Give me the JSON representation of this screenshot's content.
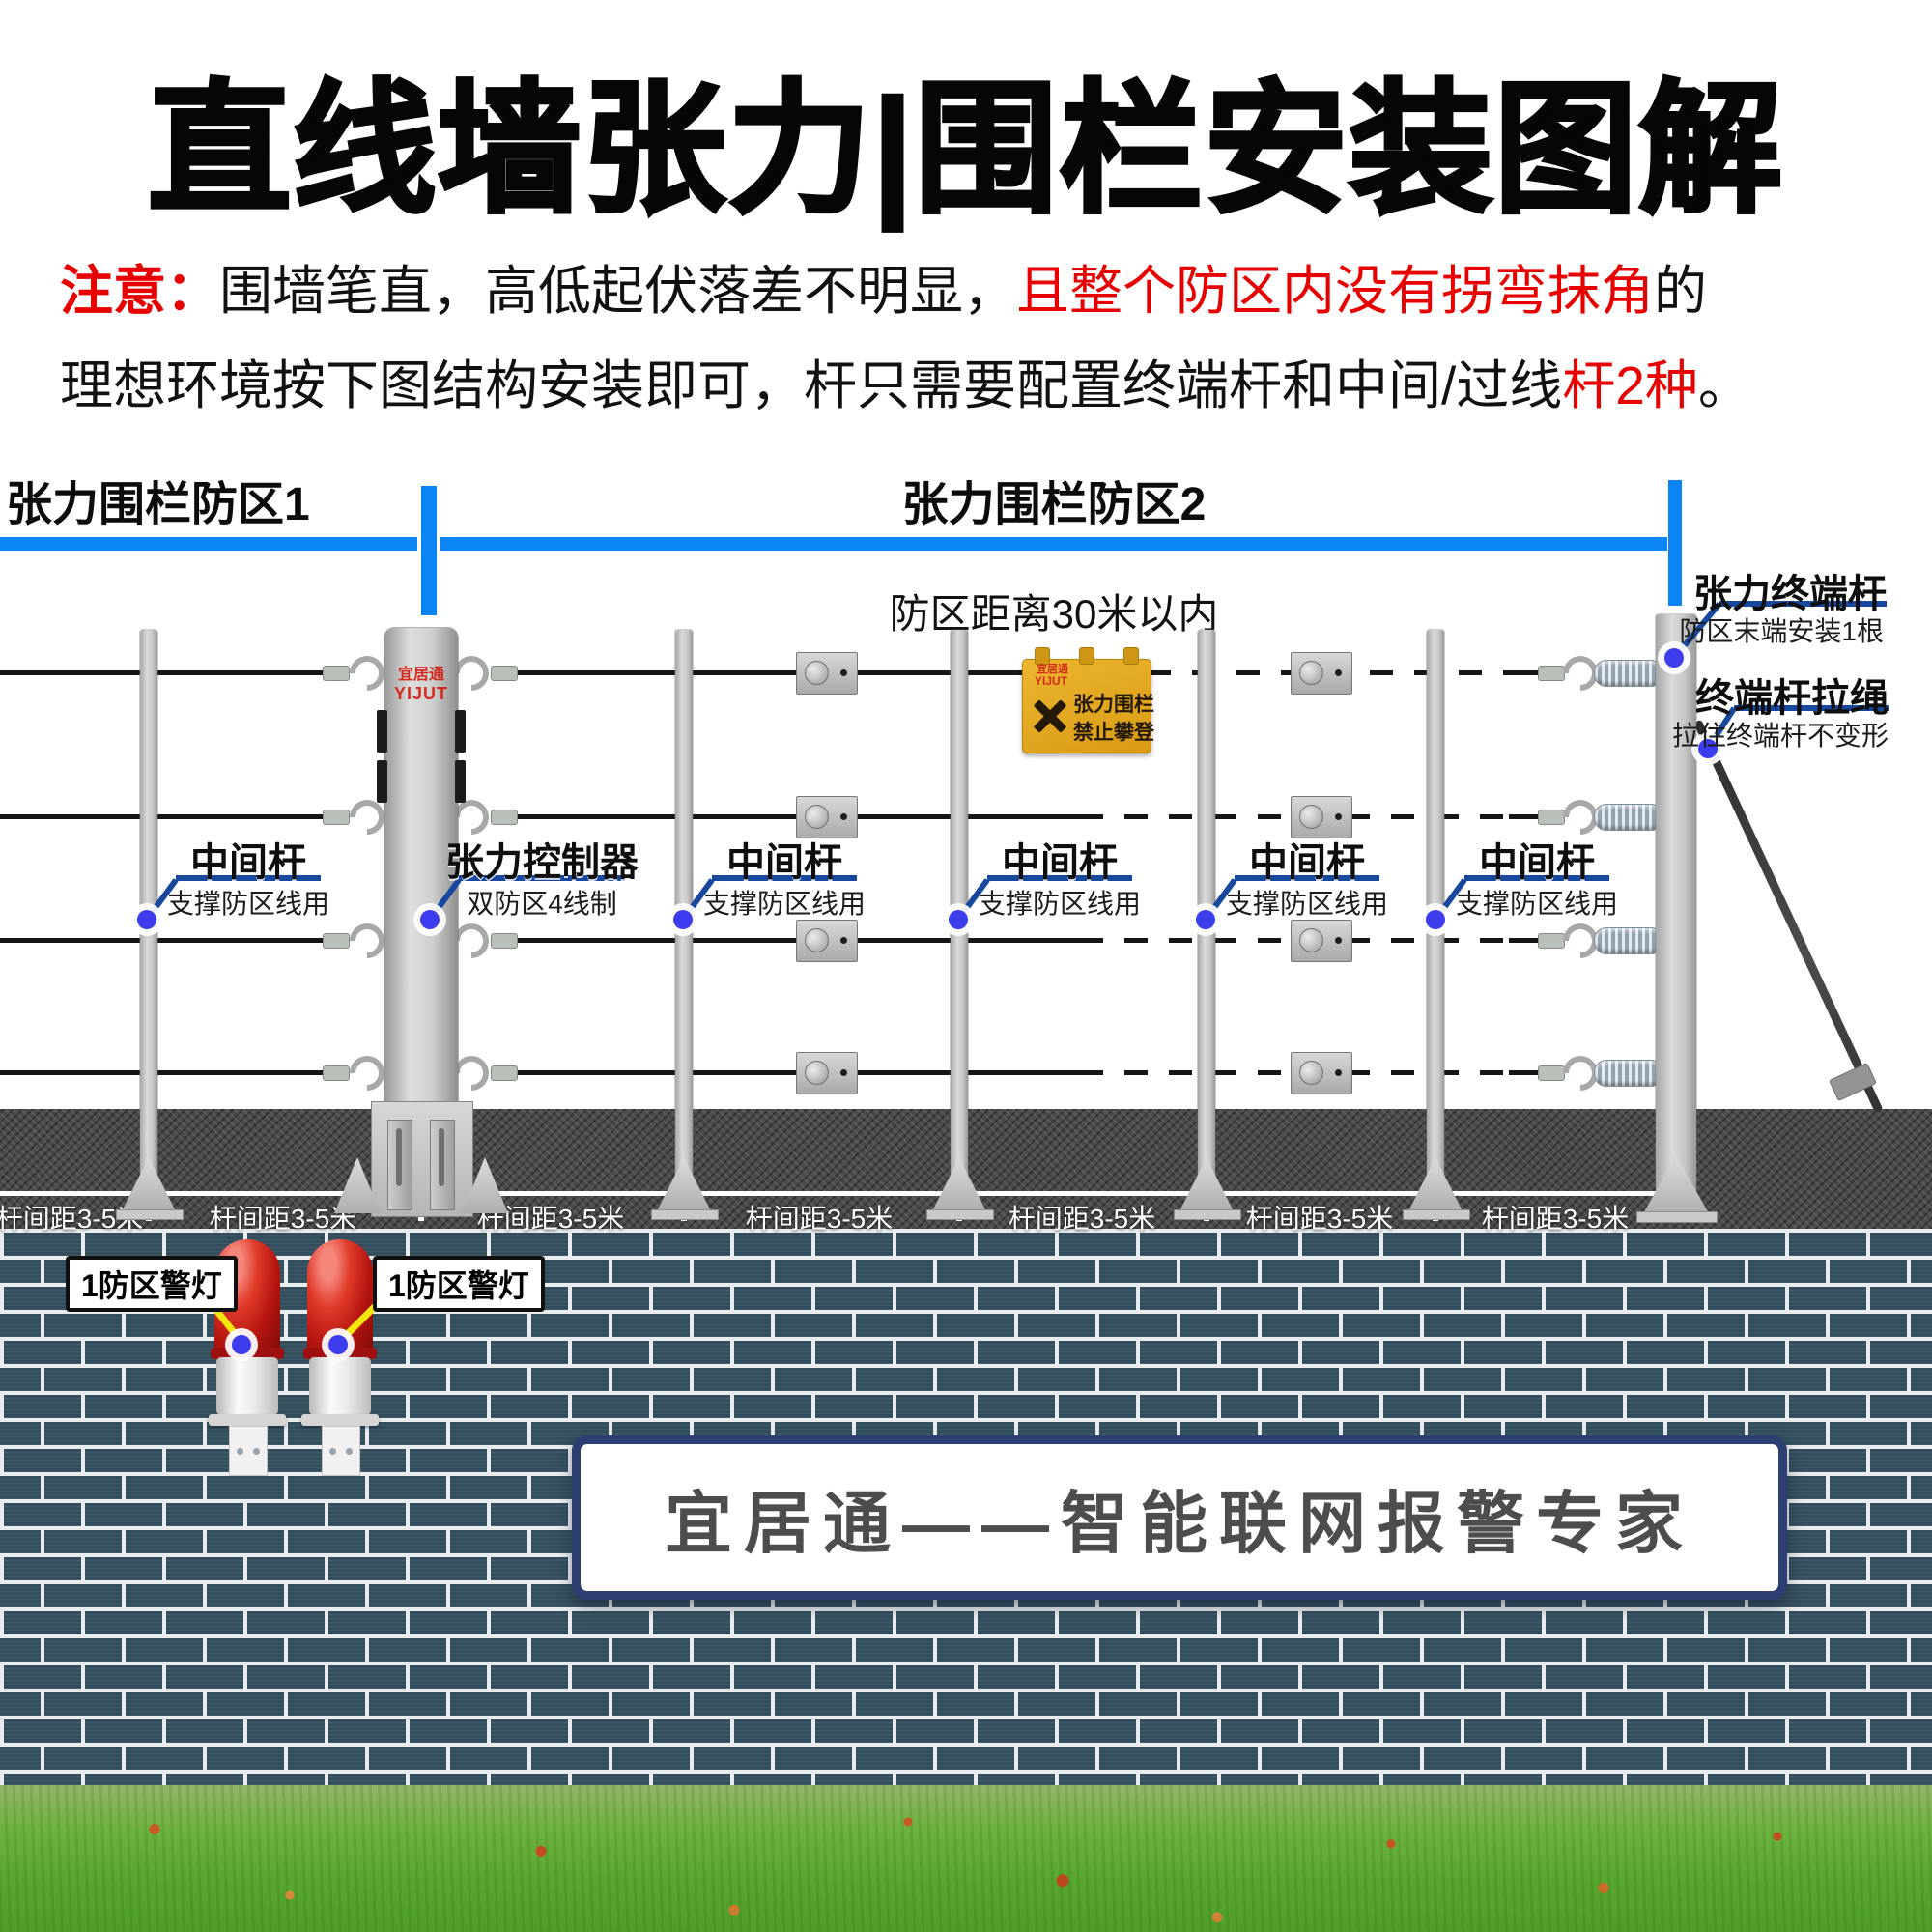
{
  "title": "直线墙张力|围栏安装图解",
  "note": {
    "prefix": "注意：",
    "line1_black": "围墙笔直，高低起伏落差不明显，",
    "line1_red": "且整个防区内没有拐弯抹角",
    "line1_tail": "的",
    "line2_black": "理想环境按下图结构安装即可，杆只需要配置终端杆和中间/过线",
    "line2_red": "杆2种",
    "line2_tail": "。"
  },
  "zones": {
    "zone1": "张力围栏防区1",
    "zone2": "张力围栏防区2",
    "zone2_sub": "防区距离30米以内"
  },
  "callouts": [
    {
      "title": "中间杆",
      "sub": "支撑防区线用"
    },
    {
      "title": "张力控制器",
      "sub": "双防区4线制"
    },
    {
      "title": "中间杆",
      "sub": "支撑防区线用"
    },
    {
      "title": "中间杆",
      "sub": "支撑防区线用"
    },
    {
      "title": "中间杆",
      "sub": "支撑防区线用"
    },
    {
      "title": "中间杆",
      "sub": "支撑防区线用"
    }
  ],
  "terminal": {
    "title": "张力终端杆",
    "sub": "防区末端安装1根",
    "rope_title": "终端杆拉绳",
    "rope_sub": "拉住终端杆不变形"
  },
  "controller_logo": {
    "cn": "宜居通",
    "en": "YIJUT"
  },
  "sign": {
    "logo_cn": "宜居通",
    "logo_en": "YIJUT",
    "line1": "张力围栏",
    "line2": "禁止攀登"
  },
  "ground": {
    "spacing": [
      "杆间距3-5米",
      "杆间距3-5米",
      "杆间距3-5米",
      "杆间距3-5米",
      "杆间距3-5米",
      "杆间距3-5米",
      "杆间距3-5米"
    ]
  },
  "alarm": {
    "labels": [
      "1防区警灯",
      "1防区警灯"
    ]
  },
  "banner": "宜居通——智能联网报警专家",
  "colors": {
    "zone_bar_blue": "#0b85f6",
    "callout_blue": "#17489e",
    "note_red": "#e60000",
    "warning_yellow": "#f2e60c",
    "sign_amber": "#e0a41e",
    "brick": "#334f5e",
    "mortar": "#e9edef",
    "alarm_red": "#c01818",
    "grass_green": "#5aa52c"
  }
}
